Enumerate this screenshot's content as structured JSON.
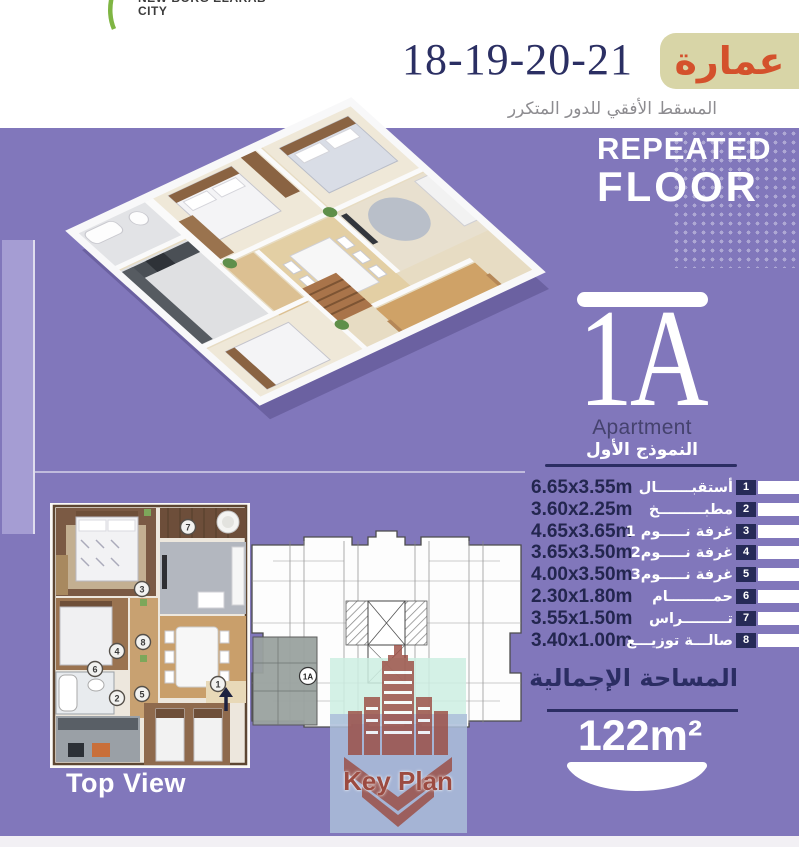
{
  "brand": {
    "line1": "NEW BORG ELARAB",
    "line2": "CITY"
  },
  "header": {
    "building_label": "عمارة",
    "building_numbers": "18-19-20-21",
    "subtitle": "المسقط الأفقي للدور المتكرر"
  },
  "banner": {
    "line1": "REPEATED",
    "line2": "FLOOR"
  },
  "apartment": {
    "code": "1A",
    "label": "Apartment",
    "model": "النموذج الأول"
  },
  "rooms": [
    {
      "num": "1",
      "name": "أستقبـــــــال",
      "dims": "6.65x3.55m"
    },
    {
      "num": "2",
      "name": "مطبـــــــــخ",
      "dims": "3.60x2.25m"
    },
    {
      "num": "3",
      "name": "غرفة نـــــوم 1",
      "dims": "4.65x3.65m"
    },
    {
      "num": "4",
      "name": "غرفة نـــــوم2",
      "dims": "3.65x3.50m"
    },
    {
      "num": "5",
      "name": "غرفة نـــــوم3",
      "dims": "4.00x3.50m"
    },
    {
      "num": "6",
      "name": "حمـــــــــام",
      "dims": "2.30x1.80m"
    },
    {
      "num": "7",
      "name": "تـــــــــراس",
      "dims": "3.55x1.50m"
    },
    {
      "num": "8",
      "name": "صالـــة توزيـــع",
      "dims": "3.40x1.00m"
    }
  ],
  "total_area": {
    "label": "المساحة الإجمالية",
    "value": "122m²"
  },
  "sections": {
    "top_view_label": "Top View",
    "key_plan_label": "Key Plan",
    "key_plan_unit": "1A"
  },
  "colors": {
    "purple": "#8177bb",
    "navy": "#2b2d63",
    "accent_red": "#d4512c",
    "badge_beige": "#d8d5a7",
    "mint": "#cdeee2",
    "unit_gray": "#9ba3a0",
    "logo_maroon": "#9b4a40"
  }
}
